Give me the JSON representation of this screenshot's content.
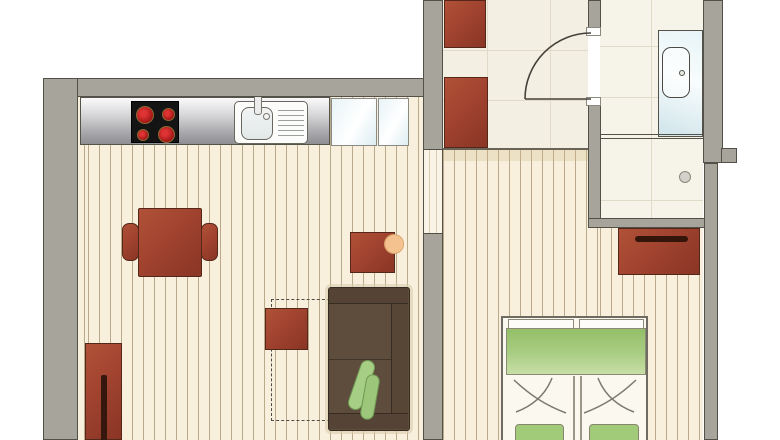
{
  "document": {
    "type": "apartment floor plan drawing",
    "title": "one-bedroom apartment top-view plan",
    "visible_text": "none"
  },
  "palette": {
    "outside": "#ffffff",
    "wall_fill": "#a7a49b",
    "wall_outline": "#53504a",
    "wood_floor": "#f8f0dc",
    "wood_stripe": "#7c633b",
    "tile_floor_hall": "#f3efe2",
    "tile_floor_bath": "#f6f3e9",
    "tile_line": "#e0dbc9",
    "furniture_red_brown": "#a1432f",
    "sofa_brown": "#5e4c3c",
    "cushion_green": "#a6ce84",
    "bed_duvet_green": "#93bf67",
    "appliance_glass_blue": "#e8f4f7",
    "stove_black": "#141414",
    "burner_red": "#c42020",
    "counter_steel": "#c9c9cb",
    "decor_ring_orange": "#f4c28f"
  },
  "rooms": [
    {
      "id": "kitchen-living-room",
      "floor": "wood planks",
      "features": [
        "kitchen-counter",
        "stove-top-four-burners",
        "kitchen-sink-with-drainboard",
        "glass-front-appliances",
        "dining-table",
        "dining-chair-left",
        "dining-chair-right",
        "sideboard-cabinet",
        "side-table",
        "decor-ring",
        "coffee-table",
        "optional-furniture-dashed-outline",
        "sofa",
        "sofa-cushion-1",
        "sofa-cushion-2"
      ]
    },
    {
      "id": "hallway",
      "floor": "tiles",
      "features": [
        "wardrobe-upper",
        "wardrobe-lower",
        "door-swing-to-bathroom",
        "passage-to-living-room"
      ]
    },
    {
      "id": "bathroom",
      "floor": "tiles",
      "features": [
        "bathtub",
        "bathtub-drain",
        "shower-drain"
      ]
    },
    {
      "id": "bedroom",
      "floor": "wood planks",
      "features": [
        "double-bed",
        "bed-duvet",
        "bed-foot-boards",
        "bed-pillows",
        "nightstand-dresser"
      ]
    }
  ],
  "counts": {
    "stove_burners": 4,
    "sofa_cushions": 2,
    "bed_halves": 2,
    "hall_wardrobes": 2,
    "glass_appliances": 2
  }
}
